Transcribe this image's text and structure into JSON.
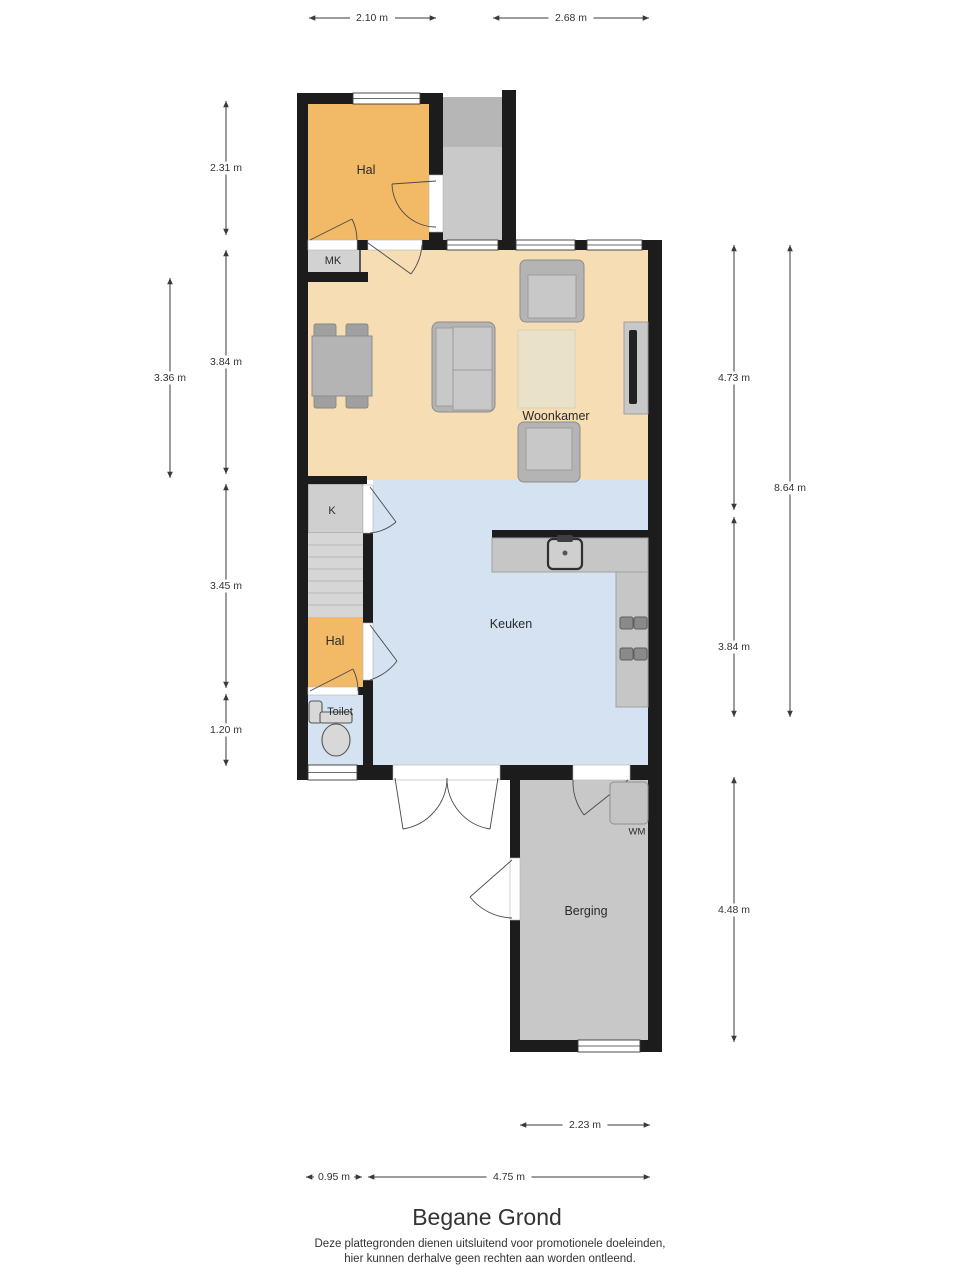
{
  "floorplan": {
    "title": "Begane Grond",
    "disclaimer": {
      "line1": "Deze plattegronden dienen uitsluitend voor promotionele doeleinden,",
      "line2": "hier kunnen derhalve geen rechten aan worden ontleend."
    },
    "rooms": {
      "hal_top": {
        "label": "Hal"
      },
      "mk": {
        "label": "MK"
      },
      "woonkamer": {
        "label": "Woonkamer"
      },
      "k": {
        "label": "K"
      },
      "hal_small": {
        "label": "Hal"
      },
      "toilet": {
        "label": "Toilet"
      },
      "keuken": {
        "label": "Keuken"
      },
      "berging": {
        "label": "Berging"
      },
      "wm": {
        "label": "WM"
      }
    },
    "dimensions": {
      "top_1": "2.10 m",
      "top_2": "2.68 m",
      "left_1": "2.31 m",
      "left_2": "3.84 m",
      "left_3": "3.45 m",
      "left_4": "1.20 m",
      "left_inner": "3.36 m",
      "right_1": "4.73 m",
      "right_2": "3.84 m",
      "right_3": "4.48 m",
      "right_outer": "8.64 m",
      "bottom_1": "2.23 m",
      "bottom_2": "0.95 m",
      "bottom_3": "4.75 m"
    },
    "colors": {
      "wall": "#1c1c1c",
      "hall_orange": "#f2ba66",
      "living_tan": "#f6ddb4",
      "kitchen_blue": "#d4e2f2",
      "storage_gray": "#c8c8c8"
    }
  }
}
